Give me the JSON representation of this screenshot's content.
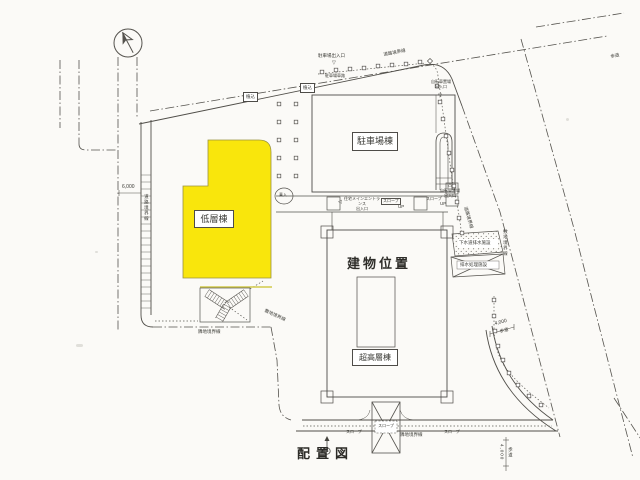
{
  "drawing": {
    "title": "配置図",
    "buildings": {
      "low_rise": "低層棟",
      "parking": "駐車場棟",
      "site_position": "建物位置",
      "high_rise": "超高層棟"
    },
    "boundaries": {
      "road": "道路境界線",
      "site": "敷地境界線",
      "adjacent": "隣地境界線"
    },
    "entrances": {
      "parking": "駐車場出入口",
      "parking_lane": "駐車場車路",
      "bicycle": "自転車置場\n出入口",
      "main": "住宅メインエントランス\n出入口",
      "drop_off": "乗入"
    },
    "features": {
      "slope": "スロープ",
      "up": "UP",
      "planting": "植込",
      "drain_facility": "下水道排水施設",
      "drain_space": "排水処理施設"
    },
    "dims": {
      "d6000": "6,000",
      "d4000": "4,000",
      "sidewalk": "歩道"
    },
    "markers": {
      "down_triangle": "▽",
      "up_triangle": "△",
      "left_triangle": "◁"
    },
    "colors": {
      "highlight_yellow": "#f9e60c",
      "line": "#4d4b47"
    }
  }
}
